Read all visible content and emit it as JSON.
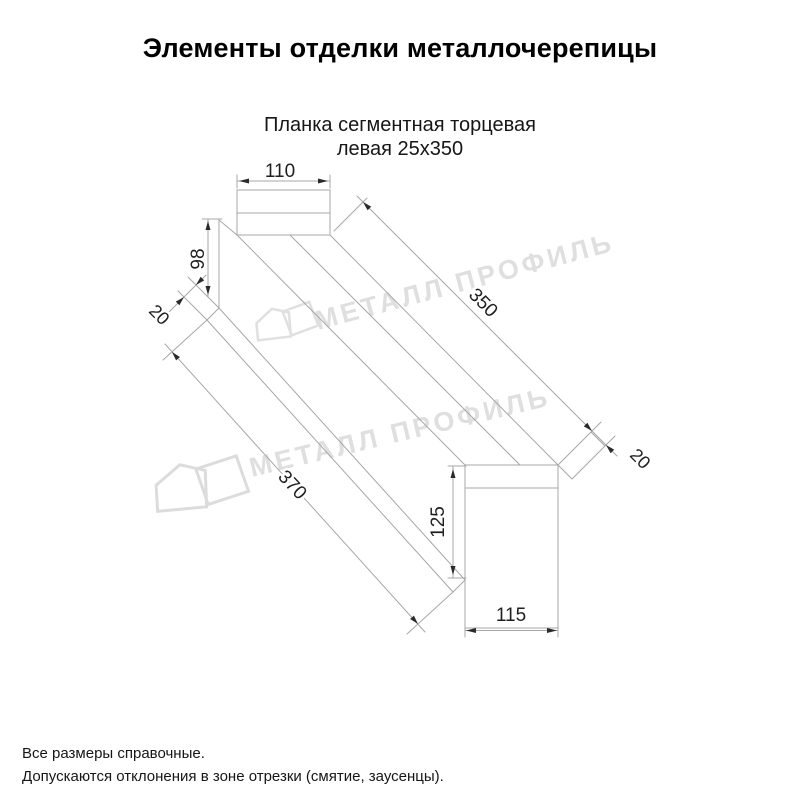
{
  "header": {
    "title": "Элементы отделки металлочерепицы"
  },
  "product": {
    "name_line1": "Планка сегментная торцевая",
    "name_line2": "левая 25x350"
  },
  "drawing": {
    "kind": "technical-dimension-drawing",
    "dims": {
      "tab_width": "110",
      "far_height": "98",
      "far_hem": "20",
      "top_length": "350",
      "end_hem": "20",
      "bottom_length": "370",
      "near_height": "125",
      "near_width": "115"
    },
    "colors": {
      "line": "#a7a7a7",
      "dim_text": "#1f1f1f",
      "arrow": "#2b2b2b"
    }
  },
  "watermark": {
    "text": "МЕТАЛЛ ПРОФИЛЬ",
    "logo": "metall-profil-house-logo",
    "color": "#dcdcdc"
  },
  "footer": {
    "note1": "Все размеры справочные.",
    "note2": "Допускаются отклонения в зоне отрезки (смятие, заусенцы)."
  }
}
